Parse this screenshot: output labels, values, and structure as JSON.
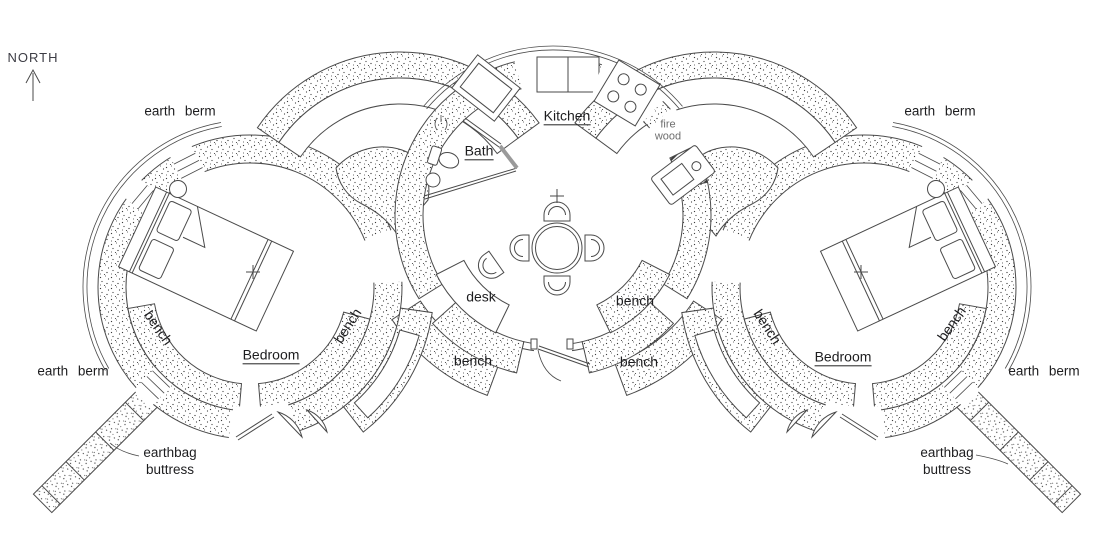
{
  "compass": {
    "label": "NORTH"
  },
  "rooms": {
    "kitchen": "Kitchen",
    "bath": "Bath",
    "bedroom_left": "Bedroom",
    "bedroom_right": "Bedroom"
  },
  "features": {
    "desk": "desk",
    "bench": "bench",
    "earth_berm": "earth berm",
    "fire_wood": {
      "line1": "fire",
      "line2": "wood"
    },
    "earthbag_buttress": {
      "line1": "earthbag",
      "line2": "buttress"
    }
  },
  "colors": {
    "ink": "#4a4a4a",
    "label_text": "#1d1d1f",
    "muted_text": "#6e6e6e",
    "door_leaf": "#9a9a9a",
    "background": "#ffffff"
  }
}
